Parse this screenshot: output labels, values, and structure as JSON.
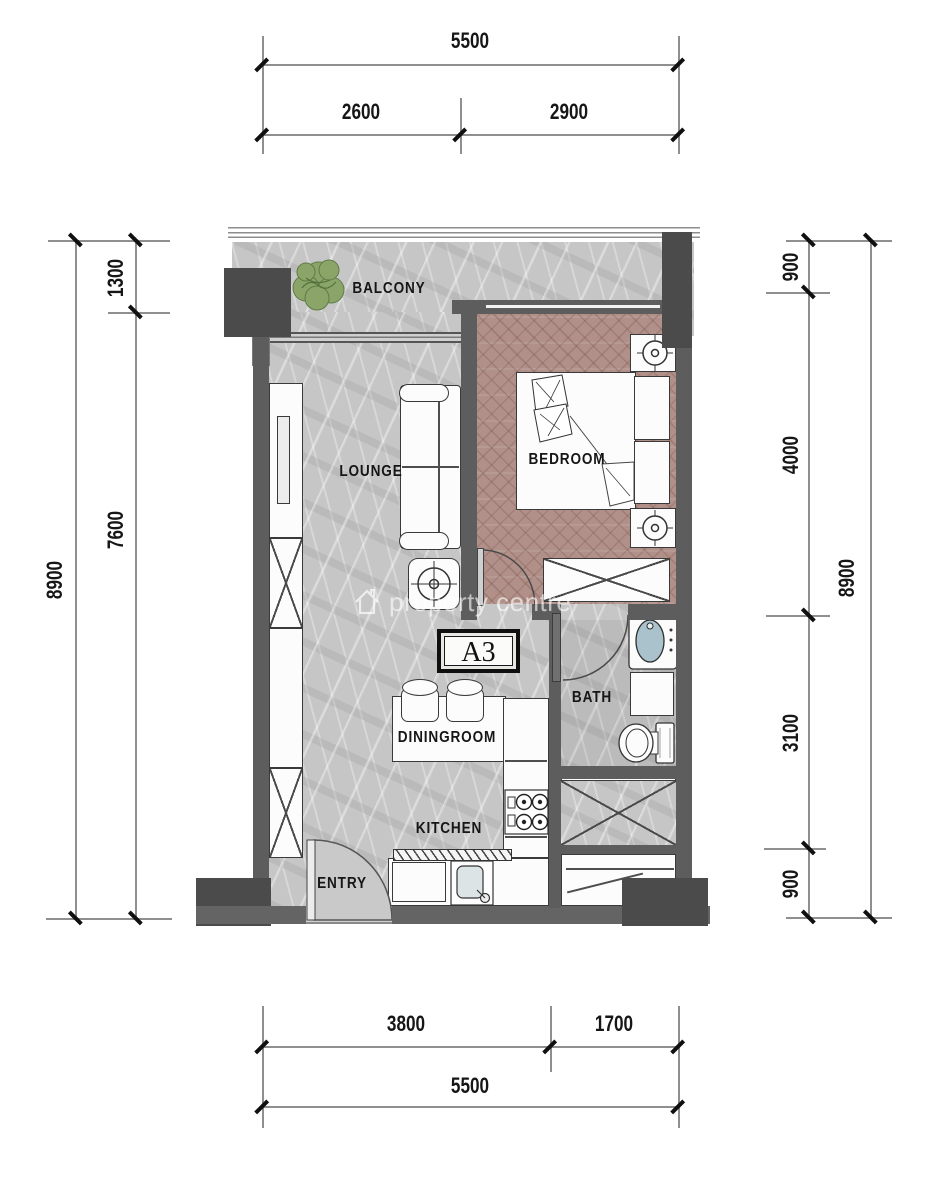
{
  "unit": {
    "label": "A3"
  },
  "watermark": {
    "text": "property centre"
  },
  "rooms": {
    "balcony": "BALCONY",
    "lounge": "LOUNGE",
    "bedroom": "BEDROOM",
    "bath": "BATH",
    "dining": "DININGROOM",
    "kitchen": "KITCHEN",
    "entry": "ENTRY"
  },
  "dims": {
    "top": {
      "total": "5500",
      "seg": [
        "2600",
        "2900"
      ]
    },
    "bottom": {
      "seg": [
        "3800",
        "1700"
      ],
      "total": "5500"
    },
    "left": {
      "total": "8900",
      "seg": [
        "1300",
        "7600"
      ]
    },
    "right": {
      "total": "8900",
      "seg": [
        "900",
        "4000",
        "3100",
        "900"
      ]
    }
  },
  "colors": {
    "wall": "#5d5d5d",
    "column": "#4b4b4b",
    "marble_floor": "#c6c6c6",
    "wood_floor": "#b19089",
    "fixture_white": "#fcfcfc",
    "basin_blue": "#a9c2cb",
    "plant_green": "#8ba569",
    "dim_text": "#161616"
  }
}
